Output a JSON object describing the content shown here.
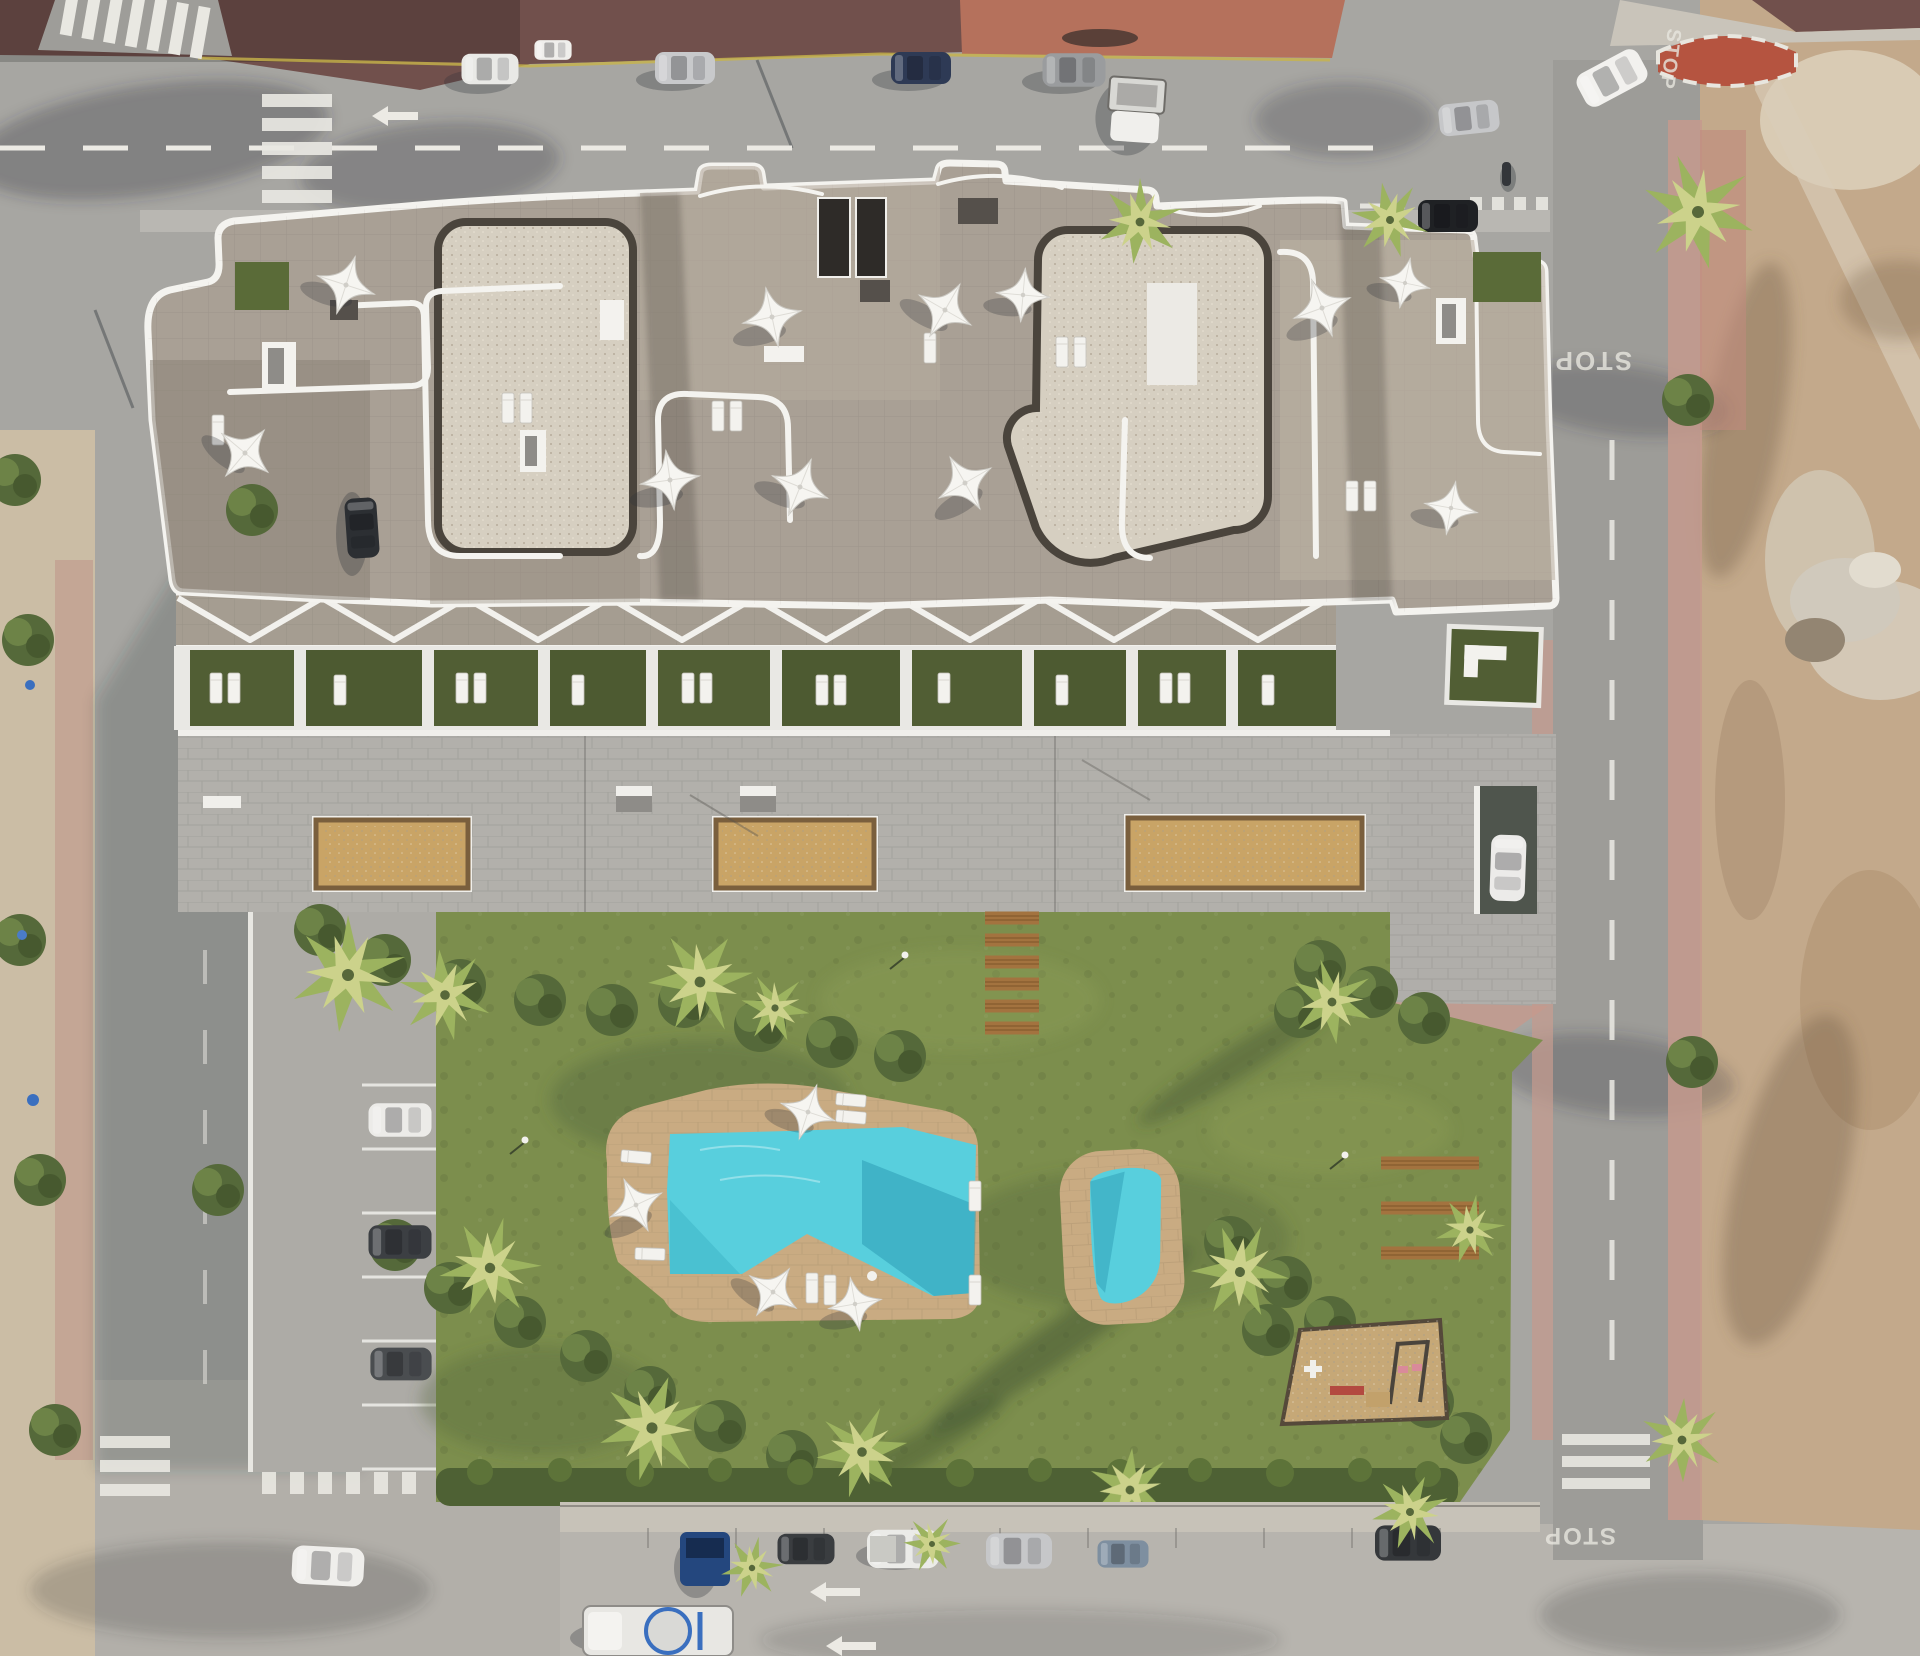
{
  "meta": {
    "title": "Aerial 3D render of residential apartment complex with communal garden and pools",
    "view": "top-down drone view",
    "image_kind": "architectural visualization"
  },
  "road_markings": {
    "stop": "STOP"
  },
  "colors": {
    "asphalt": "#a7a6a2",
    "road_bottom": "#b7b4ae",
    "road_right": "#9d9c98",
    "plaza_dark": "#71504c",
    "plaza_light": "#b5715c",
    "island_red": "#b55440",
    "dirt": "#c3a98b",
    "sand_sidewalk": "#cbbda5",
    "lawn": "#7c8e4d",
    "garden_green": "#515e34",
    "hedge": "#4e6134",
    "stone_roof": "#a9a095",
    "roof_light": "#bcb2a3",
    "gravel": "#d6cfc1",
    "gravel_border": "#4a443c",
    "terrace_concrete": "#b2b0ab",
    "apron_concrete": "#adaba6",
    "sand_court": "#c9a466",
    "pool_deck": "#c9ab82",
    "pool_water": "#58cfdd",
    "pool_shadow": "#2e9db5",
    "sidewalk_pink": "#c59a8d",
    "white_trim": "#f4f3ef"
  },
  "scene": {
    "building": {
      "label": "apartment block rooftop terraces",
      "roof_parasols": 11,
      "rooftop_chimneys": 2,
      "private_garden_units": 10,
      "pergola_band": "white zig-zag pergola beams"
    },
    "amenities": {
      "main_pool": 1,
      "small_pool": 1,
      "petanque_courts": 3,
      "playground": 1,
      "wooden_step_planks": 6,
      "wooden_loungers": 6,
      "pool_parasols": 4
    },
    "vehicles": {
      "top_street_parked": 6,
      "top_street_moving": 3,
      "motorcycle": 1,
      "bottom_street_parked": 7,
      "cement_mixer_truck": 1,
      "left_parking_bays_cars": 3,
      "garage_ramp_car": 1,
      "left_street_parked": 1
    },
    "streets": {
      "top": "two-lane street with pedestrian crossings",
      "left": "street with perpendicular parking bays",
      "right": "street beside vacant dirt lot",
      "bottom": "street with parallel parking and direction arrows",
      "stop_markings": 3,
      "crosswalks": 6
    }
  }
}
